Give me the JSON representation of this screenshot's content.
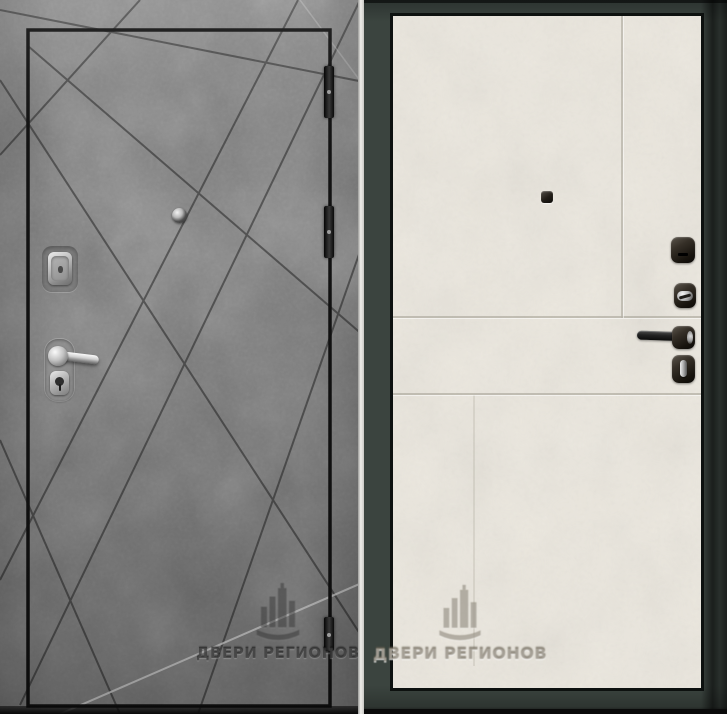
{
  "watermark": {
    "brand": "ДВЕРИ РЕГИОНОВ"
  },
  "exterior_side": {
    "finish_color": "#7f7f7f",
    "groove_color": "#1c1c1c",
    "edge_outline_color": "#131313",
    "hinge_count": 3,
    "hardware_finish": "#c9c9c9"
  },
  "interior_side": {
    "leaf_color": "#eceae2",
    "frame_color": "#3b443f",
    "hardware_finish": "#18140e"
  }
}
